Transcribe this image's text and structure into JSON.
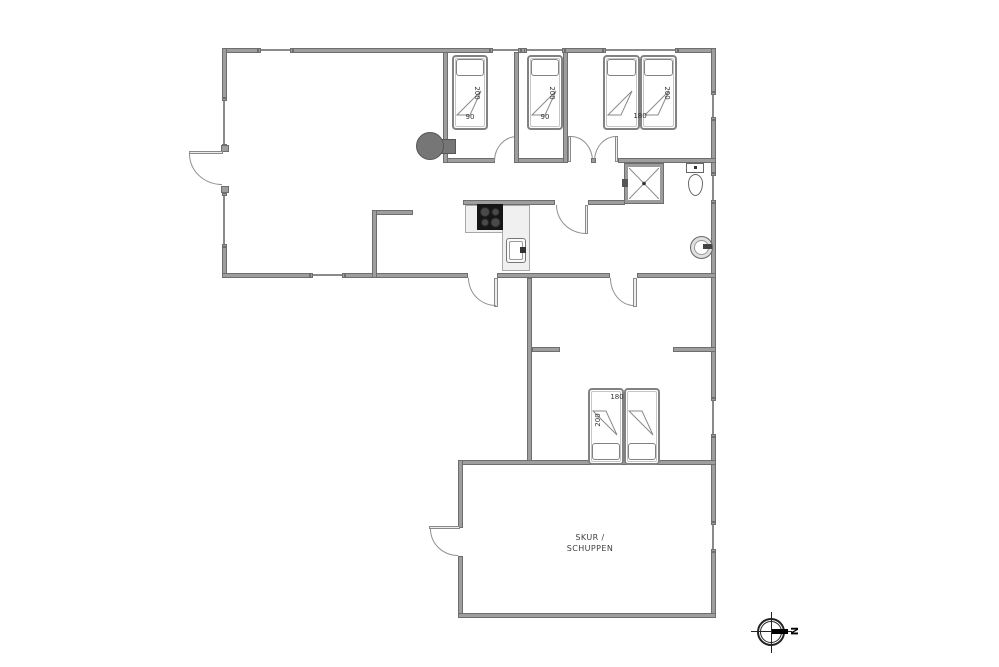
{
  "plan": {
    "beds": {
      "bedroom1_bed": {
        "length": "200",
        "width": "90"
      },
      "bedroom2_bed": {
        "length": "200",
        "width": "90"
      },
      "bedroom3_double_bed": {
        "length": "200",
        "width": "180"
      },
      "south_double_bed": {
        "length": "200",
        "width": "180"
      }
    },
    "shed": {
      "label_line1": "SKUR /",
      "label_line2": "SCHUPPEN"
    },
    "compass": {
      "north": "N"
    },
    "colors": {
      "wall_fill": "#9e9e9e",
      "wall_edge": "#6e6e6e",
      "window_line": "#8a8a8a",
      "wood_stove": "#767676",
      "cooktop": "#161616",
      "counter": "#f0f0f0",
      "text": "#333333"
    }
  }
}
